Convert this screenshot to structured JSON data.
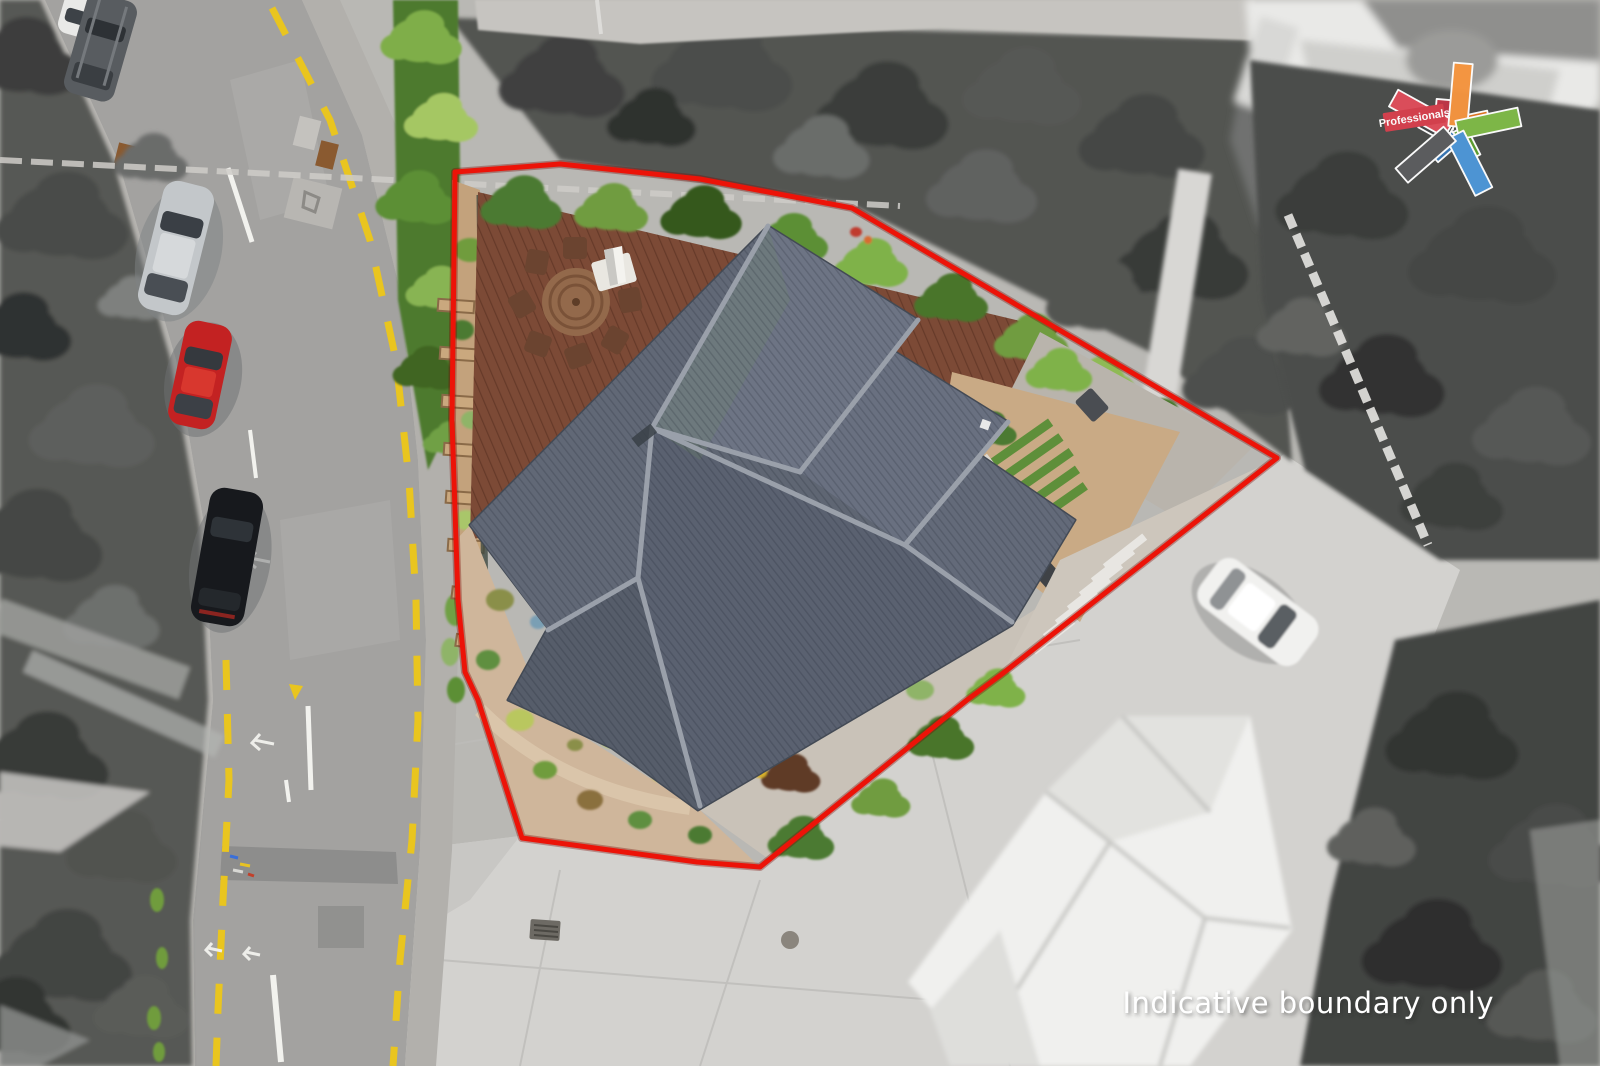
{
  "watermark": {
    "text": "Indicative boundary only",
    "color": "#ffffff"
  },
  "logo": {
    "label": "Professionals",
    "label_color": "#ffffff",
    "banner_color": "#d7404e",
    "colors": {
      "red": "#df4d5b",
      "red_dark": "#bf3547",
      "orange": "#f6953f",
      "orange_dark": "#e0751f",
      "green": "#7fba47",
      "green_dark": "#5c9e2f",
      "blue": "#4e97d8",
      "blue_dark": "#3877b6",
      "gray": "#5c5d5f",
      "gray_dark": "#454648"
    }
  },
  "boundary": {
    "color": "#ec1308"
  },
  "road": {
    "yellow_line": "#e9c51f",
    "white_line": "#f2f2ee"
  }
}
